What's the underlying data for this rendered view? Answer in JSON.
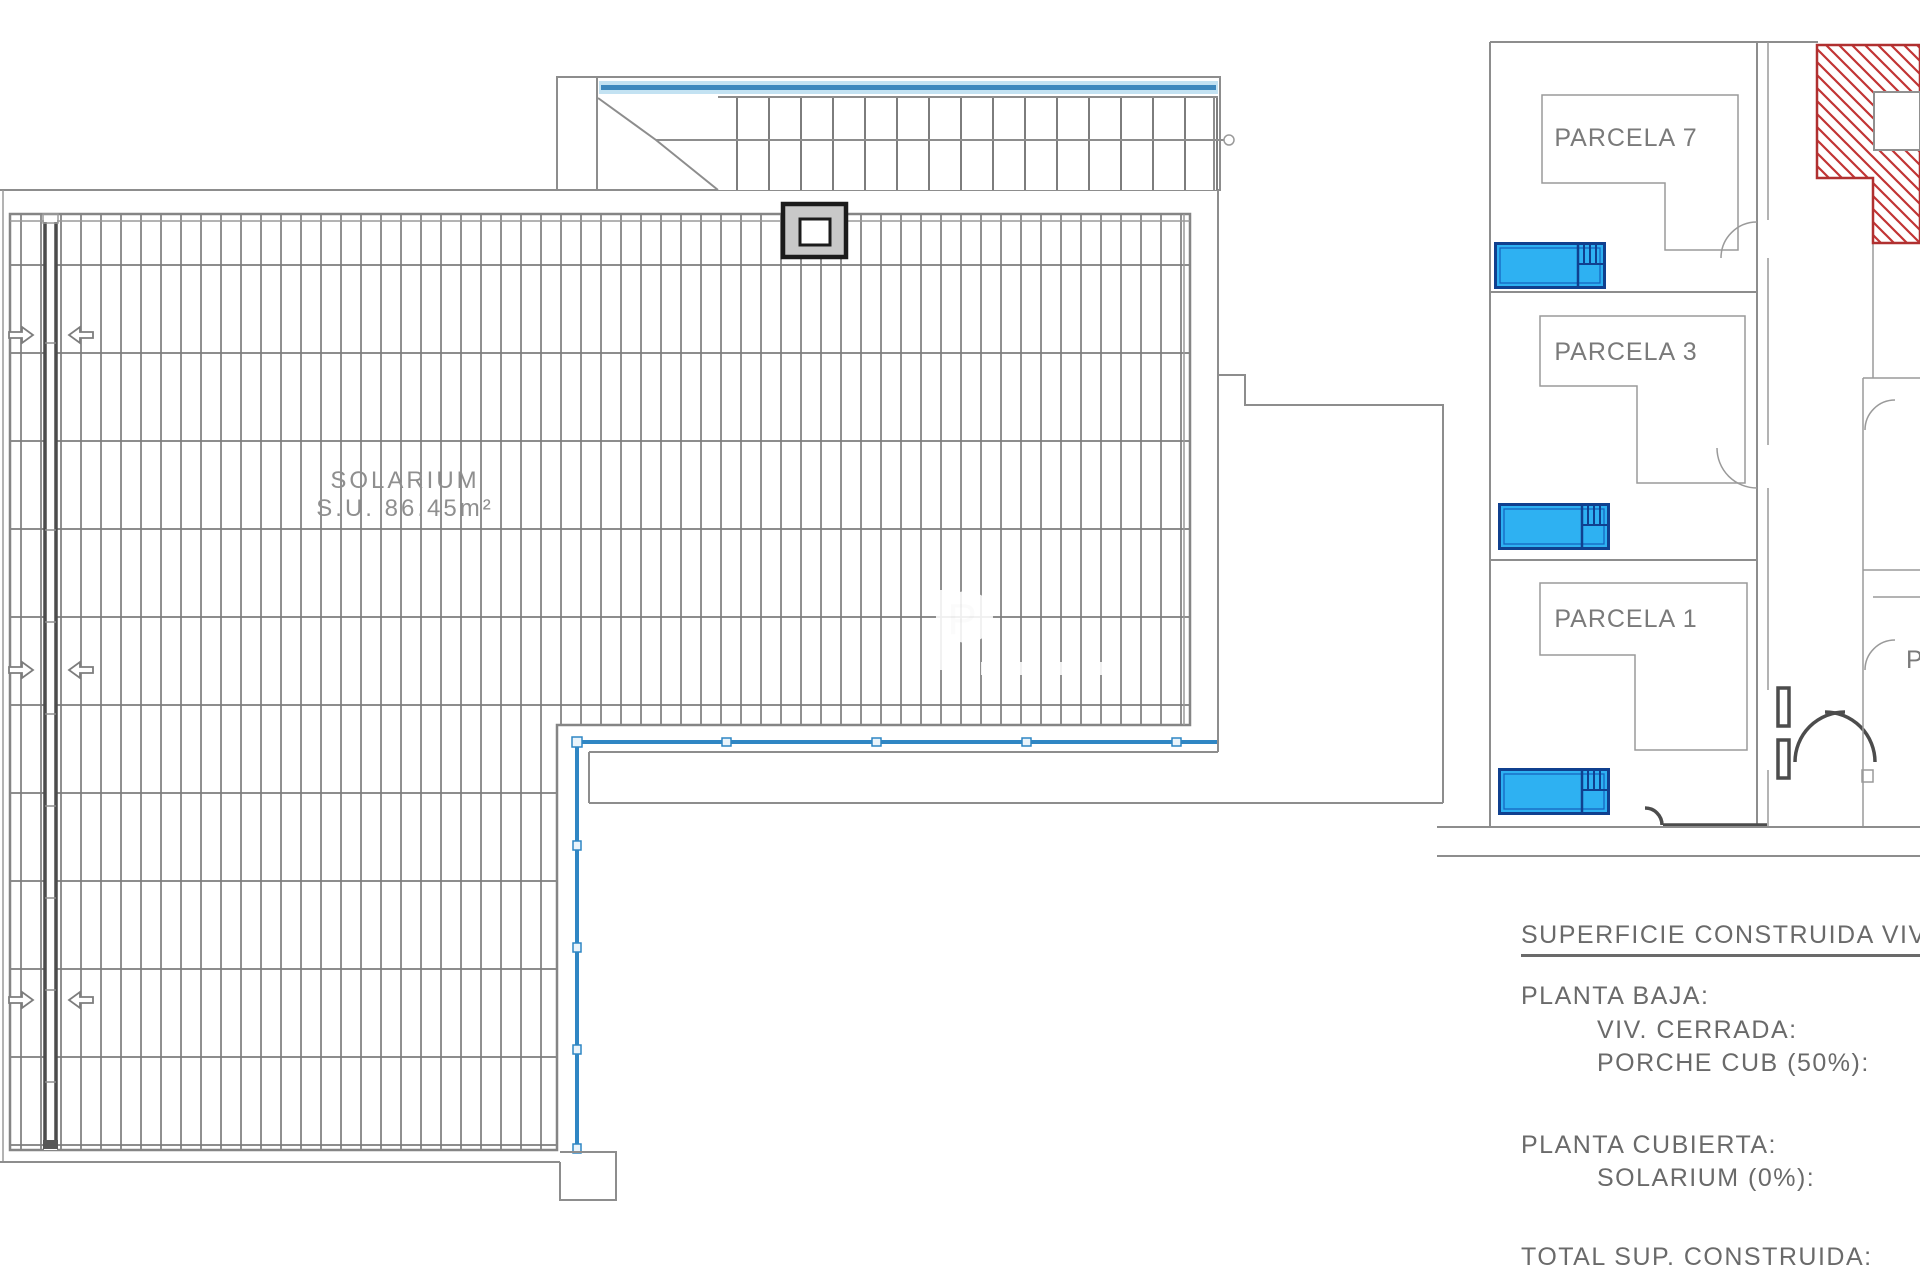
{
  "plan": {
    "solarium_label": {
      "name": "SOLARIUM",
      "area": "S.U. 86.45m²"
    }
  },
  "site_plan": {
    "parcels": [
      {
        "label": "PARCELA 7"
      },
      {
        "label": "PARCELA 3"
      },
      {
        "label": "PARCELA 1"
      }
    ],
    "neighbor_label_partial": "P"
  },
  "summary": {
    "title": "SUPERFICIE CONSTRUIDA VIV 3",
    "sections": [
      {
        "heading": "PLANTA BAJA:",
        "items": [
          "VIV. CERRADA:",
          "PORCHE CUB (50%):"
        ]
      },
      {
        "heading": "PLANTA CUBIERTA:",
        "items": [
          "SOLARIUM (0%):"
        ]
      }
    ],
    "total_label": "TOTAL SUP. CONSTRUIDA:"
  },
  "watermark": {
    "monogram": "P"
  },
  "colors": {
    "pool_fill": "#2eb1f2",
    "pool_border": "#10408f",
    "railing_blue": "#2f86c4",
    "hatch_red": "#c23434",
    "line_gray": "#8d8d8d",
    "text_gray": "#6a6a6a"
  }
}
